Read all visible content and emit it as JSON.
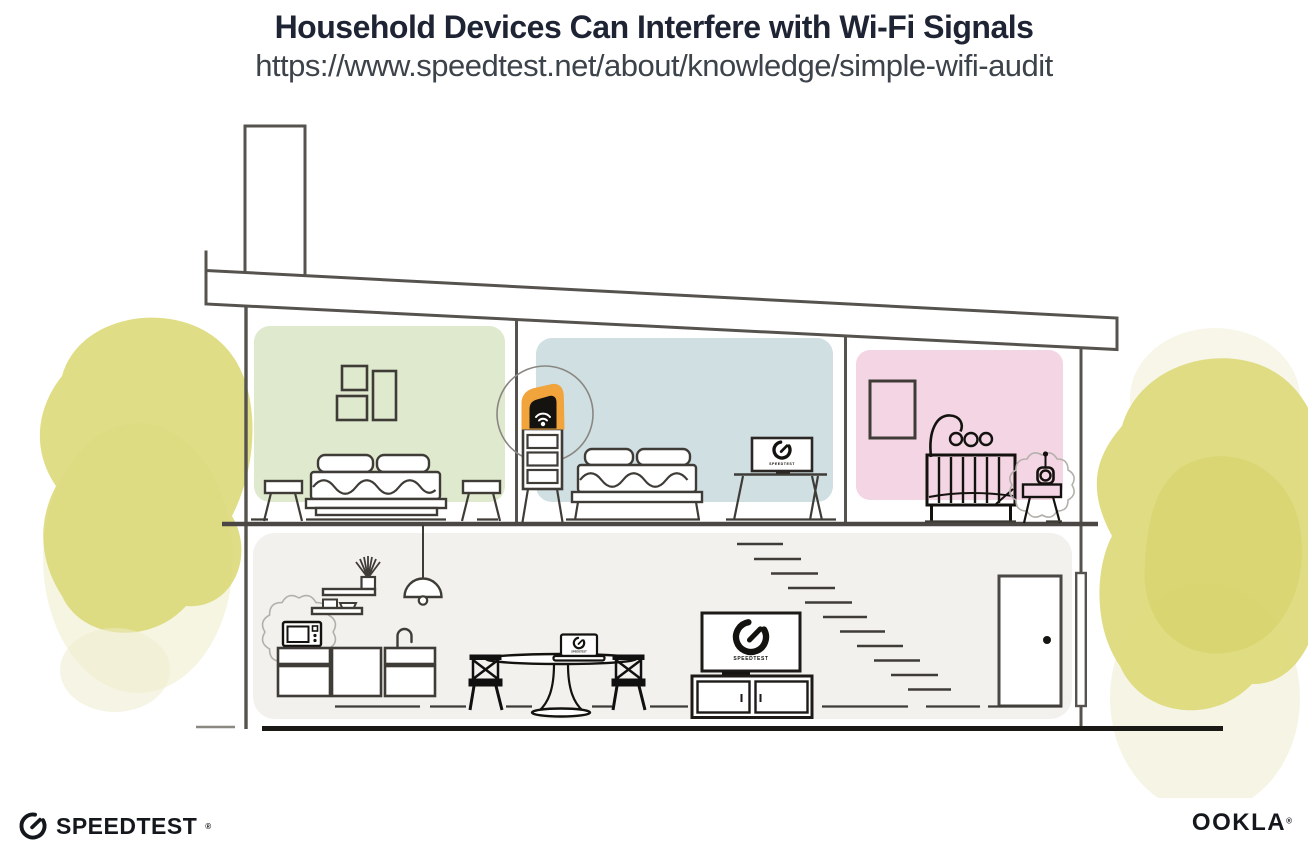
{
  "header": {
    "title": "Household Devices Can Interfere with Wi-Fi Signals",
    "subtitle_url": "https://www.speedtest.net/about/knowledge/simple-wifi-audit"
  },
  "illustration": {
    "tv_screen_label": "SPEEDTEST",
    "bedroom_monitor_label": "SPEEDTEST",
    "laptop_screen_label": "SPEEDTEST"
  },
  "footer": {
    "speedtest_label": "SPEEDTEST",
    "speedtest_trademark": "®",
    "ookla_label": "OOKLA",
    "ookla_trademark": "®"
  },
  "colors": {
    "title_text": "#1e2433",
    "subtitle_text": "#3d434b",
    "outline": "#56534e",
    "furniture_line": "#3f3c38",
    "ground": "#1b1916",
    "room_green": "#dfe9cd",
    "room_blue": "#cfdfe2",
    "room_pink": "#f4d5e4",
    "lower_floor": "#f2f1ee",
    "router_highlight": "#f1a33c",
    "router_device": "#15130f",
    "bush_main": "#dcd979",
    "bush_light": "#eeeccb",
    "bush_dark": "#d2ce5f",
    "logo_text": "#14171c"
  }
}
